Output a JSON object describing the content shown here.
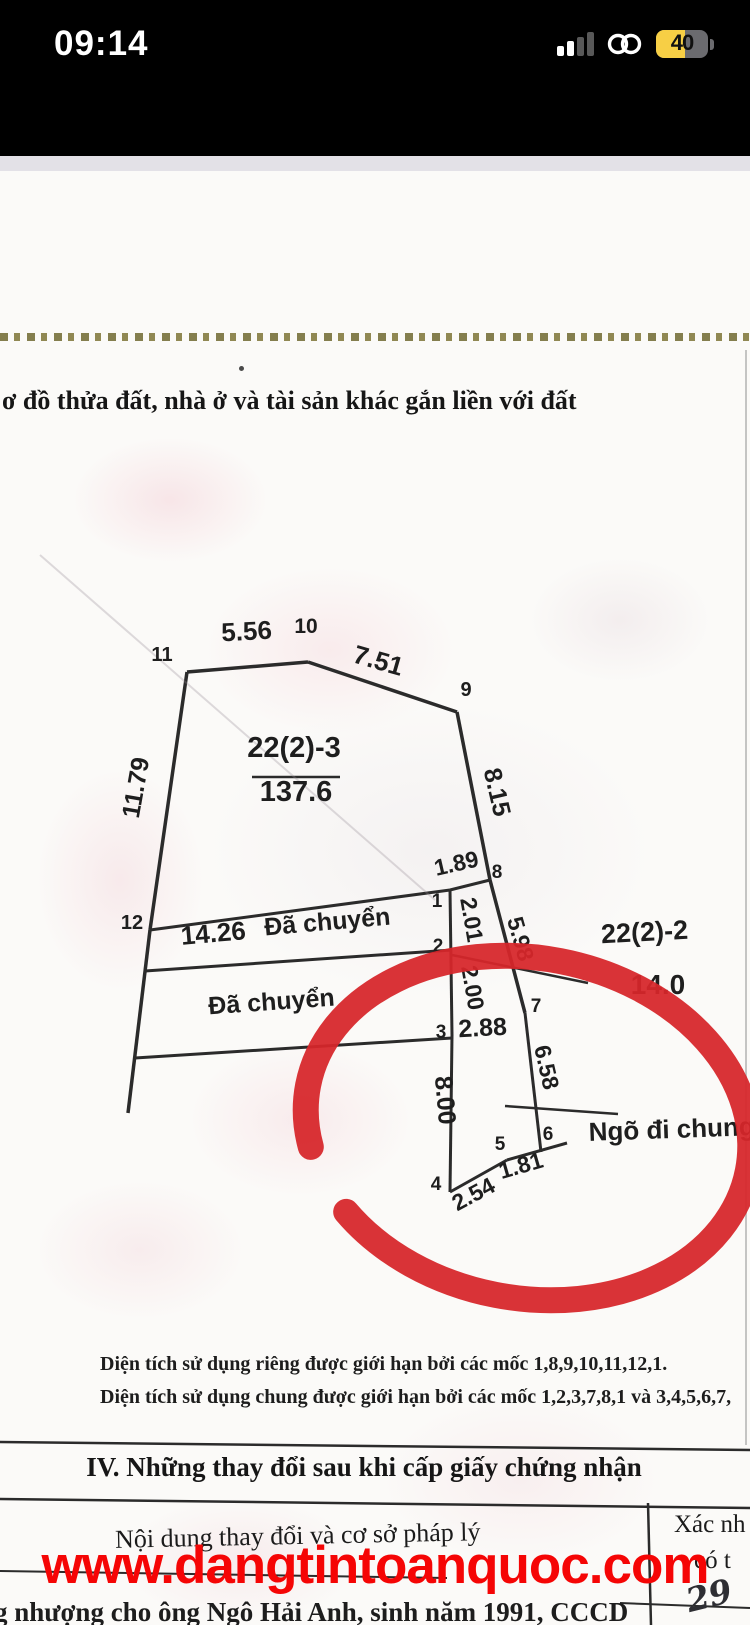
{
  "status_bar": {
    "time": "09:14",
    "battery_percent": "40",
    "icons": [
      "cellular-signal-icon",
      "link-icon",
      "battery-icon"
    ]
  },
  "colors": {
    "annotation_red": "#d7262b",
    "watermark_red": "#f50505",
    "battery_yellow": "#f7cf45",
    "doc_line": "#2b2b2b"
  },
  "document": {
    "title": "ơ đồ thửa đất, nhà ở và tài sản khác gắn liền với đất",
    "notes": [
      "Diện tích sử dụng riêng được giới hạn bởi các mốc 1,8,9,10,11,12,1.",
      "Diện tích sử dụng chung được giới hạn bởi các mốc 1,2,3,7,8,1 và 3,4,5,6,7,"
    ],
    "section_iv": {
      "heading": "IV. Những thay đổi sau khi cấp giấy chứng nhận",
      "table": {
        "left_header": "Nội dung thay đổi và cơ sở pháp lý",
        "right_header_line1": "Xác nh",
        "right_header_line2": "có t",
        "handwritten_note": "29"
      }
    },
    "bottom_text": "g nhượng cho ông Ngô Hải Anh, sinh năm 1991, CCCD"
  },
  "watermark": {
    "text": "www.dangtintoanquoc.com"
  },
  "diagram": {
    "parcel_label": "22(2)-3",
    "parcel_area": "137.6",
    "adjacent_parcel_label": "22(2)-2",
    "adjacent_parcel_length": "14.0",
    "alley_label": "Ngõ đi chung",
    "transferred_label": "Đã chuyển",
    "vertex_numbers": [
      "1",
      "2",
      "3",
      "4",
      "5",
      "6",
      "7",
      "8",
      "9",
      "10",
      "11",
      "12"
    ],
    "edge_lengths": [
      "5.56",
      "7.51",
      "8.15",
      "11.79",
      "14.26",
      "1.89",
      "2.01",
      "5.98",
      "2.00",
      "2.88",
      "6.58",
      "8.00",
      "2.54",
      "1.81",
      "14.0"
    ],
    "segments": [
      {
        "x1": 187,
        "y1": 672,
        "x2": 308,
        "y2": 662,
        "w": 3.5
      },
      {
        "x1": 308,
        "y1": 662,
        "x2": 457,
        "y2": 712,
        "w": 3.5
      },
      {
        "x1": 457,
        "y1": 712,
        "x2": 490,
        "y2": 880,
        "w": 3.5
      },
      {
        "x1": 490,
        "y1": 880,
        "x2": 525,
        "y2": 1013,
        "w": 3.5
      },
      {
        "x1": 525,
        "y1": 1013,
        "x2": 541,
        "y2": 1152,
        "w": 3
      },
      {
        "x1": 187,
        "y1": 672,
        "x2": 150,
        "y2": 930,
        "w": 3.5
      },
      {
        "x1": 150,
        "y1": 930,
        "x2": 128,
        "y2": 1113,
        "w": 3.5
      },
      {
        "x1": 150,
        "y1": 930,
        "x2": 450,
        "y2": 890,
        "w": 3
      },
      {
        "x1": 145,
        "y1": 971,
        "x2": 452,
        "y2": 950,
        "w": 3
      },
      {
        "x1": 135,
        "y1": 1058,
        "x2": 452,
        "y2": 1038,
        "w": 3
      },
      {
        "x1": 450,
        "y1": 890,
        "x2": 490,
        "y2": 880,
        "w": 3
      },
      {
        "x1": 450,
        "y1": 890,
        "x2": 452,
        "y2": 1035,
        "w": 3
      },
      {
        "x1": 452,
        "y1": 1035,
        "x2": 450,
        "y2": 1192,
        "w": 3
      },
      {
        "x1": 450,
        "y1": 1192,
        "x2": 507,
        "y2": 1160,
        "w": 3
      },
      {
        "x1": 507,
        "y1": 1160,
        "x2": 567,
        "y2": 1143,
        "w": 3
      },
      {
        "x1": 505,
        "y1": 1106,
        "x2": 618,
        "y2": 1114,
        "w": 2.5
      },
      {
        "x1": 452,
        "y1": 955,
        "x2": 588,
        "y2": 983,
        "w": 2.5
      },
      {
        "x1": 252,
        "y1": 777,
        "x2": 340,
        "y2": 777,
        "w": 2.5
      },
      {
        "x1": 40,
        "y1": 555,
        "x2": 435,
        "y2": 900,
        "w": 2,
        "c": "rgba(150,140,150,0.3)"
      },
      {
        "x1": 746,
        "y1": 350,
        "x2": 746,
        "y2": 1445,
        "w": 2,
        "c": "rgba(160,160,160,0.6)"
      },
      {
        "x1": 0,
        "y1": 1442,
        "x2": 750,
        "y2": 1450,
        "w": 2.5
      },
      {
        "x1": 0,
        "y1": 1499,
        "x2": 750,
        "y2": 1508,
        "w": 2.5
      },
      {
        "x1": 0,
        "y1": 1571,
        "x2": 447,
        "y2": 1578,
        "w": 2
      },
      {
        "x1": 620,
        "y1": 1603,
        "x2": 750,
        "y2": 1608,
        "w": 2
      },
      {
        "x1": 648,
        "y1": 1503,
        "x2": 651,
        "y2": 1625,
        "w": 2.5
      }
    ],
    "labels": [
      {
        "t": "11",
        "x": 162,
        "y": 661,
        "r": 0,
        "s": 20
      },
      {
        "t": "5.56",
        "x": 247,
        "y": 640,
        "r": -3,
        "s": 26
      },
      {
        "t": "10",
        "x": 306,
        "y": 633,
        "r": 0,
        "s": 21
      },
      {
        "t": "7.51",
        "x": 376,
        "y": 669,
        "r": 16,
        "s": 26
      },
      {
        "t": "9",
        "x": 466,
        "y": 696,
        "r": 0,
        "s": 20
      },
      {
        "t": "8.15",
        "x": 489,
        "y": 794,
        "r": 77,
        "s": 25
      },
      {
        "t": "11.79",
        "x": 144,
        "y": 789,
        "r": -80,
        "s": 25
      },
      {
        "t": "22(2)-3",
        "x": 294,
        "y": 757,
        "r": 0,
        "s": 29
      },
      {
        "t": "137.6",
        "x": 296,
        "y": 801,
        "r": 0,
        "s": 29
      },
      {
        "t": "12",
        "x": 132,
        "y": 929,
        "r": 0,
        "s": 20
      },
      {
        "t": "14.26",
        "x": 214,
        "y": 942,
        "r": -5,
        "s": 26
      },
      {
        "t": "Đã chuyển",
        "x": 328,
        "y": 930,
        "r": -5,
        "s": 25
      },
      {
        "t": "Đã chuyển",
        "x": 272,
        "y": 1010,
        "r": -4,
        "s": 25
      },
      {
        "t": "1",
        "x": 437,
        "y": 907,
        "r": 0,
        "s": 19
      },
      {
        "t": "1.89",
        "x": 458,
        "y": 871,
        "r": -13,
        "s": 23
      },
      {
        "t": "8",
        "x": 497,
        "y": 878,
        "r": 0,
        "s": 19
      },
      {
        "t": "2.01",
        "x": 464,
        "y": 921,
        "r": 80,
        "s": 23
      },
      {
        "t": "2",
        "x": 438,
        "y": 952,
        "r": 0,
        "s": 19
      },
      {
        "t": "5.98",
        "x": 513,
        "y": 941,
        "r": 74,
        "s": 23
      },
      {
        "t": "2.00",
        "x": 465,
        "y": 989,
        "r": 80,
        "s": 23
      },
      {
        "t": "3",
        "x": 441,
        "y": 1038,
        "r": 0,
        "s": 19
      },
      {
        "t": "2.88",
        "x": 483,
        "y": 1036,
        "r": -3,
        "s": 25
      },
      {
        "t": "7",
        "x": 536,
        "y": 1012,
        "r": 0,
        "s": 19
      },
      {
        "t": "6.58",
        "x": 539,
        "y": 1069,
        "r": 77,
        "s": 23
      },
      {
        "t": "8.00",
        "x": 437,
        "y": 1101,
        "r": 85,
        "s": 25
      },
      {
        "t": "4",
        "x": 436,
        "y": 1190,
        "r": 0,
        "s": 19
      },
      {
        "t": "2.54",
        "x": 477,
        "y": 1201,
        "r": -28,
        "s": 23
      },
      {
        "t": "5",
        "x": 500,
        "y": 1150,
        "r": 0,
        "s": 19
      },
      {
        "t": "1.81",
        "x": 523,
        "y": 1173,
        "r": -16,
        "s": 23
      },
      {
        "t": "6",
        "x": 548,
        "y": 1140,
        "r": 0,
        "s": 19
      },
      {
        "t": "Ngõ đi chung",
        "x": 672,
        "y": 1138,
        "r": -2,
        "s": 26
      },
      {
        "t": "22(2)-2",
        "x": 645,
        "y": 941,
        "r": -3,
        "s": 27
      },
      {
        "t": "14.0",
        "x": 658,
        "y": 994,
        "r": 0,
        "s": 28
      }
    ],
    "red_circle": {
      "cx": 528,
      "cy": 1128,
      "rx": 224,
      "ry": 170,
      "rotate": 11,
      "stroke_width": 26,
      "dash": "39 6 55",
      "color": "#d7262b"
    }
  }
}
